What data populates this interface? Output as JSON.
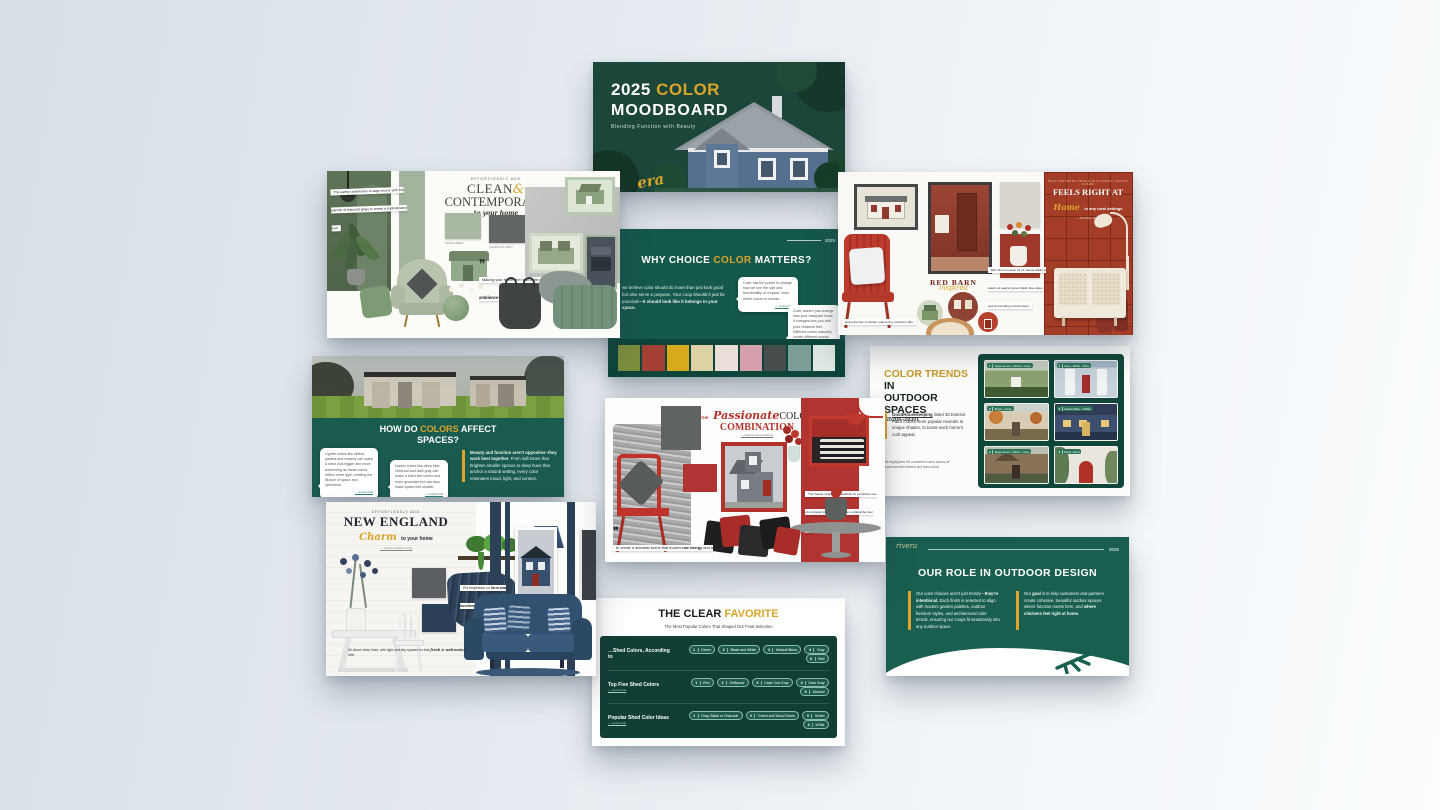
{
  "colors": {
    "gold": "#d9a42a",
    "deep_green": "#1c463a",
    "teal_green": "#15594c",
    "barn_red": "#a33d28",
    "navy": "#32506f",
    "sage": "#a9b8a3"
  },
  "slides": {
    "title": {
      "year": "2025",
      "color_word": "COLOR",
      "moodboard": "MOODBOARD",
      "subtitle": "Blending Function with Beauty",
      "brand_script": "era"
    },
    "clean": {
      "tag": "effortlessly add",
      "title_a": "CLEAN",
      "amp": "&",
      "title_b": "CONTEMPORARY",
      "sub": "to your home",
      "note": "The earthy undertones of sage source with the warmth of charcoal grays to create a sophisticated look",
      "quote_a": "Making your home feel neat while keeping",
      "quote_b": "the ambience modern and sleek",
      "swatch1": "#a9b8a3",
      "swatch2": "#5f6663",
      "swatch1_name": "SAGE GREEN",
      "swatch2_name": "CHARCOAL GRAY"
    },
    "why": {
      "year": "2025",
      "title_pre": "WHY CHOICE ",
      "title_gold": "COLOR",
      "title_post": " MATTERS?",
      "body_pre": "we believe color should do more than just look good but also serve a purpose. Your coop shouldn't just be practical",
      "body_bold": "—it should look like it belongs in your space.",
      "bubble1": "Color has the power to change how we see the size and functionality of a space, even which colors to choose.",
      "bubble1_src": "— source link",
      "bubble2": "Color doesn't just change how your backyard looks, it changes how you and your chickens feel. Different colors naturally create different moods.",
      "bubble2_src": "— source link",
      "palette": [
        "#7d8f3c",
        "#a43f33",
        "#d8ab1f",
        "#ddd1a5",
        "#e9dfd8",
        "#d59fac",
        "#474c4c",
        "#7f9d98",
        "#dfe9e3"
      ]
    },
    "barn": {
      "tagline": "BOLD AND RETRO DESIGN AN AUTHENTIC RUSTIC CHARM",
      "title": "FEELS RIGHT AT",
      "script": "Home",
      "title_rest": "in any rural settings",
      "credit": "— Red Barn Paint",
      "label_a": "RED BARN",
      "label_b": "inspired",
      "quote": "Barn Red is known for its natural ability to stand out against green fields, blue skies, and surrounding environments,",
      "note": "giving the barn a vibrant, welcoming rural farm vibe."
    },
    "how": {
      "title_pre": "HOW DO ",
      "title_gold": "COLORS",
      "title_post": " AFFECT",
      "title_line2": "SPACES?",
      "bubble1": "Lighter colors like whites, pastels and creams can make a shed look bigger and more welcoming as these colors reflect more light, creating the illusion of space and openness.",
      "bubble1_src": "— source link",
      "bubble2": "Darker colors like deep blue, charcoal and dark gray can make a shed feel cozier and more grounded but can also make space feel smaller.",
      "bubble2_src": "— source link",
      "highlight_bold": "Beauty and function aren't opposites–they work best together.",
      "highlight_rest": "From soft tones that brighten smaller spaces to deep hues that anchor a natural setting, every color resonates mood, light, and context."
    },
    "passionate": {
      "the": "The",
      "script": "Passionate",
      "title_a": "COLOR",
      "title_b": "COMBINATION",
      "sub": "— interiors and exteriors",
      "note": "The impact of the red, thankfully its consistent use of a singular tone gives the room a distinctive feel with the movement of grays.",
      "quote_pre": "to create a dramatic scene that evokes ",
      "quote_bold": "raw energy",
      "quote_mid": " and a ",
      "quote_bold2": "hint of drama."
    },
    "trends": {
      "title_gold": "COLOR TRENDS",
      "title_dark": " IN",
      "title_line2": "OUTDOOR SPACES",
      "years": "(2020s–2030)",
      "body_link": "GoodHousekeeping",
      "body": " listed 30 Exterior Paint Colors, from popular neutrals to unique shades, to boost each home's curb appeal.",
      "note": "We highlighted the consistent colors across all recommended exterior and shed colors.",
      "photos": [
        {
          "num": "1",
          "label": "Sage Green + Wood + Gray"
        },
        {
          "num": "2",
          "label": "Teal + White + Blue"
        },
        {
          "num": "3",
          "label": "Beige + Gray"
        },
        {
          "num": "4",
          "label": "Classic Blue + White"
        },
        {
          "num": "5",
          "label": "Sage Green + Brick + Gray"
        },
        {
          "num": "6",
          "label": "Sand + Red"
        }
      ]
    },
    "newengland": {
      "tag": "effortlessly add",
      "title": "NEW ENGLAND",
      "script": "Charm",
      "sub": "to your home",
      "credit": "— Inspire Coastal Living",
      "note_a": "Put emphasis on",
      "note_b": "form and function",
      "bottom": "All about clean lines, with light and airy spaces for that ",
      "brand": "fresh & welcoming",
      "bottom_end": " vibe"
    },
    "favorite": {
      "title_dark": "THE CLEAR ",
      "title_gold": "FAVORITE",
      "subtitle": "The Most Popular Colors That Shaped Our Final Selection",
      "rows": [
        {
          "label": "…Shed Colors, According to",
          "pills": [
            {
              "n": "1",
              "t": "Green"
            },
            {
              "n": "2",
              "t": "Black and White"
            },
            {
              "n": "3",
              "t": "Neutral Blues"
            },
            {
              "n": "4",
              "t": "Gray"
            },
            {
              "n": "5",
              "t": "Red"
            }
          ]
        },
        {
          "label": "Top Five Shed Colors",
          "link": "— source link",
          "pills": [
            {
              "n": "1",
              "t": "Red"
            },
            {
              "n": "2",
              "t": "Driftwood"
            },
            {
              "n": "3",
              "t": "Cape Cod Gray"
            },
            {
              "n": "4",
              "t": "Dark Gray"
            },
            {
              "n": "5",
              "t": "Almond"
            }
          ]
        },
        {
          "label": "Popular Shed Color Ideas",
          "link": "— source link",
          "pills": [
            {
              "n": "1",
              "t": "Gray, Black or Charcoal"
            },
            {
              "n": "2",
              "t": "Green and Wood Tones"
            },
            {
              "n": "3",
              "t": "Green"
            },
            {
              "n": "4",
              "t": "White"
            }
          ]
        }
      ]
    },
    "ourrole": {
      "brand_script": "rivera",
      "year": "2025",
      "title": "OUR ROLE IN OUTDOOR DESIGN",
      "col1_pre": "Our color choices aren't just trendy—",
      "col1_bold": "they're intentional.",
      "col1_rest": " Each finish is selected to align with modern garden palettes, outdoor furniture styles, and architectural color trends, ensuring our coops fit seamlessly into any outdoor space.",
      "col2_pre": "Our ",
      "col2_bold": "goal",
      "col2_mid": " is to help customers and partners create cohesive, beautiful outdoor spaces where function meets form, and ",
      "col2_bold2": "where chickens feel right at home."
    }
  }
}
